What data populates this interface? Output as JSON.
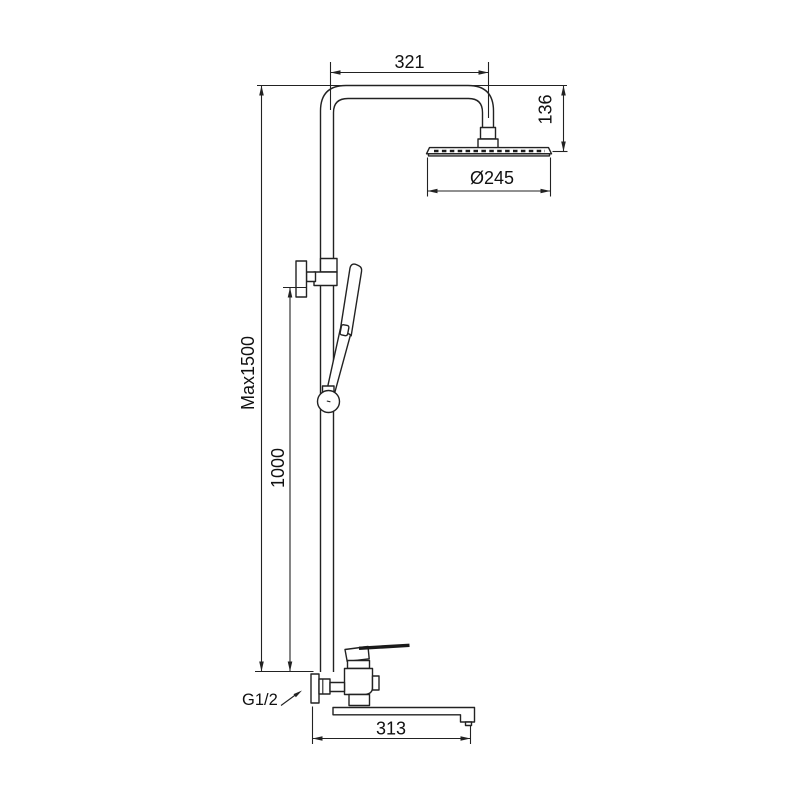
{
  "drawing": {
    "colors": {
      "line": "#222222",
      "background": "#ffffff"
    },
    "labels": {
      "arm_reach": "321",
      "head_drop": "136",
      "head_diameter": "Ø245",
      "max_height": "Max1500",
      "slide_bar": "1000",
      "thread": "G1/2",
      "spout_length": "313"
    }
  }
}
